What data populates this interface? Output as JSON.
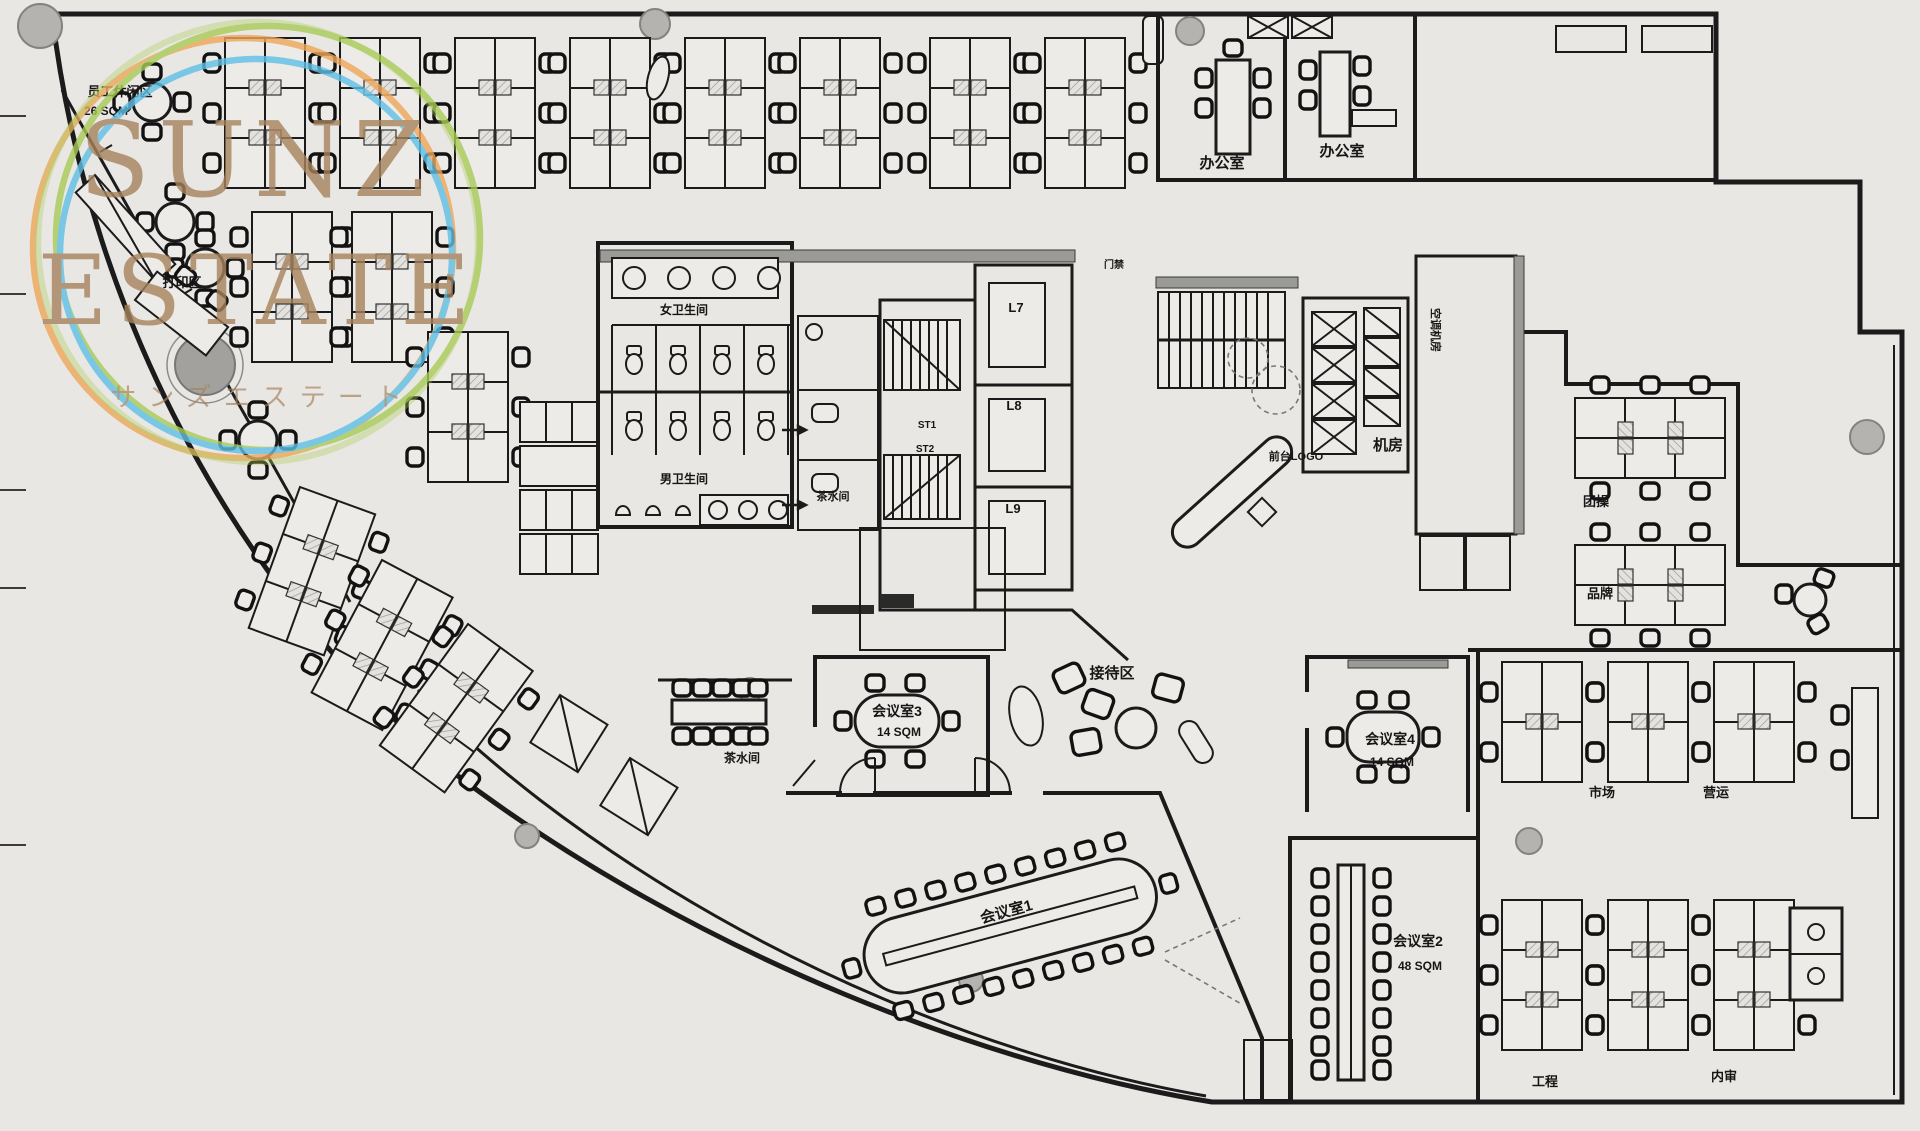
{
  "watermark": {
    "line1": "SUNZ",
    "line2": "ESTATE",
    "subtitle": "サンズエステート",
    "text_color": "#a6835c",
    "ring_orange": "#efa75a",
    "ring_green": "#a9cb57",
    "ring_blue": "#5fc0e6"
  },
  "colors": {
    "background": "#e9e7e4",
    "floor": "#edebe8",
    "wall": "#1b1b1b",
    "hatch_fill": "#d8d6d2",
    "hatch_line": "#72726f",
    "concrete": "#9a9a97",
    "column_fill": "#b5b3b0"
  },
  "labels": {
    "staff_lounge": "员工休闲区",
    "staff_lounge_area": "26 SQM",
    "print_area": "打印区",
    "office_left": "办公室",
    "office_right": "办公室",
    "womens_restroom": "女卫生间",
    "mens_restroom": "男卫生间",
    "pantry_small": "茶水间",
    "elevator_l7": "L7",
    "elevator_l8": "L8",
    "elevator_l9": "L9",
    "stair_st1": "ST1",
    "stair_st2": "ST2",
    "access_door": "门禁",
    "front_desk": "前台LOGO",
    "machine_room": "机房",
    "hvac_room": "空调机房",
    "team_training": "团操",
    "brand": "品牌",
    "reception": "接待区",
    "meeting_room_3": "会议室3",
    "meeting_room_3_area": "14 SQM",
    "meeting_room_4": "会议室4",
    "meeting_room_4_area": "14 SQM",
    "pantry": "茶水间",
    "meeting_room_1": "会议室1",
    "meeting_room_2": "会议室2",
    "meeting_room_2_area": "48 SQM",
    "marketing": "市场",
    "operations": "营运",
    "engineering": "工程",
    "internal_audit": "内审"
  }
}
